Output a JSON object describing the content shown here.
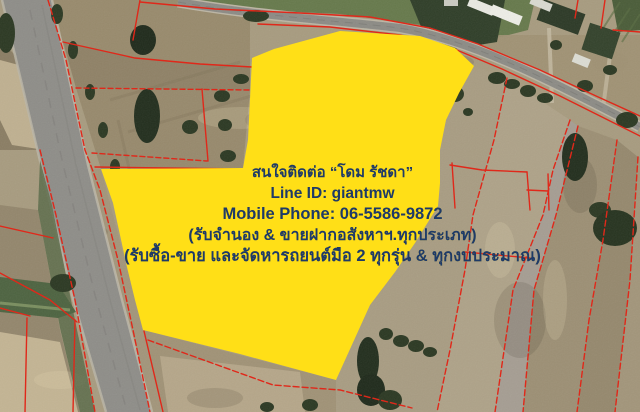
{
  "overlay": {
    "lines": [
      "สนใจติดต่อ “โดม รัชดา”",
      "Line ID: giantmw",
      "Mobile Phone: 06-5586-9872",
      "(รับจำนอง & ขายฝากอสังหาฯ.ทุกประเภท)",
      "(รับซื้อ-ขาย และจัดหารถยนต์มือ 2 ทุกรุ่น & ทุกงบประมาณ)"
    ]
  },
  "colors": {
    "parcel_highlight": "#FFDF17",
    "parcel_boundaries": "#E0281A",
    "contact_text": "#1E3A68"
  }
}
